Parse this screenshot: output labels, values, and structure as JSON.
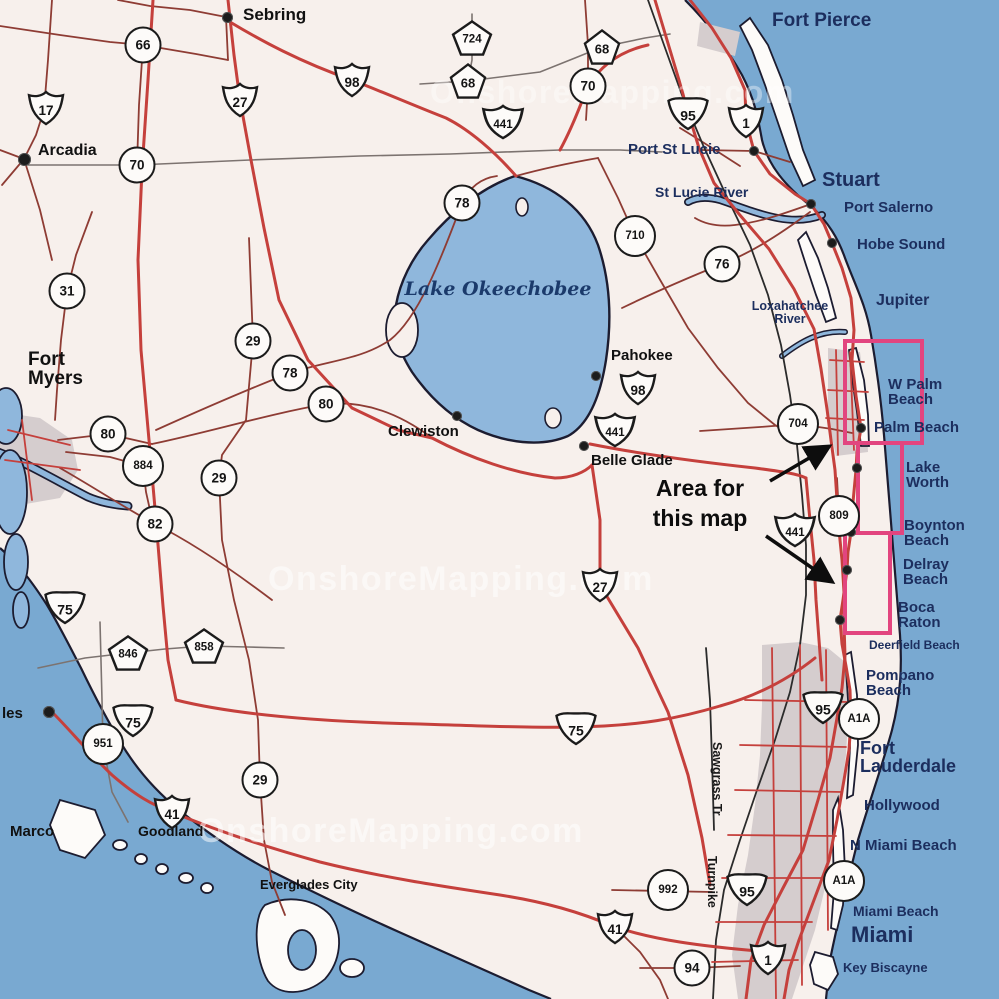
{
  "watermark": {
    "text": "OnshoreMapping.com"
  },
  "annotation": {
    "line1": "Area for",
    "line2": "this map"
  },
  "lake": {
    "label": "Lake Okeechobee"
  },
  "colors": {
    "ocean": "#79a9d1",
    "land": "#f7f0ec",
    "lake": "#8fb7dc",
    "urban": "#d5cdce",
    "road_major": "#c5403c",
    "road_minor": "#8e3c34",
    "road_gray": "#7c7370",
    "road_black": "#2b2b2b",
    "highlight_pink": "#e2457f",
    "coast_outline": "#1c1c30",
    "city_coastal": "#1c2e5e",
    "city_inland": "#111111"
  },
  "road_labels": [
    {
      "text": "Sawgrass Tr",
      "x": 724,
      "y": 742
    },
    {
      "text": "Turnpike",
      "x": 719,
      "y": 856
    }
  ],
  "shields": [
    {
      "t": "us",
      "l": "17",
      "x": 46,
      "y": 108
    },
    {
      "t": "us",
      "l": "27",
      "x": 240,
      "y": 100
    },
    {
      "t": "us",
      "l": "98",
      "x": 352,
      "y": 80
    },
    {
      "t": "us",
      "l": "441",
      "x": 503,
      "y": 122
    },
    {
      "t": "us",
      "l": "98",
      "x": 638,
      "y": 388
    },
    {
      "t": "us",
      "l": "441",
      "x": 615,
      "y": 430
    },
    {
      "t": "us",
      "l": "441",
      "x": 795,
      "y": 530
    },
    {
      "t": "us",
      "l": "27",
      "x": 600,
      "y": 585
    },
    {
      "t": "us",
      "l": "41",
      "x": 172,
      "y": 812
    },
    {
      "t": "us",
      "l": "41",
      "x": 615,
      "y": 927
    },
    {
      "t": "us",
      "l": "1",
      "x": 746,
      "y": 121
    },
    {
      "t": "us",
      "l": "1",
      "x": 768,
      "y": 958
    },
    {
      "t": "i",
      "l": "95",
      "x": 688,
      "y": 112
    },
    {
      "t": "i",
      "l": "95",
      "x": 823,
      "y": 706
    },
    {
      "t": "i",
      "l": "95",
      "x": 747,
      "y": 888
    },
    {
      "t": "i",
      "l": "75",
      "x": 65,
      "y": 606
    },
    {
      "t": "i",
      "l": "75",
      "x": 133,
      "y": 719
    },
    {
      "t": "i",
      "l": "75",
      "x": 576,
      "y": 727
    },
    {
      "t": "c",
      "l": "66",
      "x": 143,
      "y": 45
    },
    {
      "t": "c",
      "l": "70",
      "x": 137,
      "y": 165
    },
    {
      "t": "c",
      "l": "70",
      "x": 588,
      "y": 86
    },
    {
      "t": "c",
      "l": "78",
      "x": 462,
      "y": 203
    },
    {
      "t": "c",
      "l": "78",
      "x": 290,
      "y": 373
    },
    {
      "t": "c",
      "l": "710",
      "x": 635,
      "y": 236
    },
    {
      "t": "c",
      "l": "76",
      "x": 722,
      "y": 264
    },
    {
      "t": "c",
      "l": "31",
      "x": 67,
      "y": 291
    },
    {
      "t": "c",
      "l": "29",
      "x": 253,
      "y": 341
    },
    {
      "t": "c",
      "l": "80",
      "x": 326,
      "y": 404
    },
    {
      "t": "c",
      "l": "80",
      "x": 108,
      "y": 434
    },
    {
      "t": "c",
      "l": "884",
      "x": 143,
      "y": 466
    },
    {
      "t": "c",
      "l": "29",
      "x": 219,
      "y": 478
    },
    {
      "t": "c",
      "l": "82",
      "x": 155,
      "y": 524
    },
    {
      "t": "c",
      "l": "704",
      "x": 798,
      "y": 424
    },
    {
      "t": "c",
      "l": "809",
      "x": 839,
      "y": 516
    },
    {
      "t": "c",
      "l": "951",
      "x": 103,
      "y": 744
    },
    {
      "t": "c",
      "l": "29",
      "x": 260,
      "y": 780
    },
    {
      "t": "c",
      "l": "992",
      "x": 668,
      "y": 890
    },
    {
      "t": "c",
      "l": "94",
      "x": 692,
      "y": 968
    },
    {
      "t": "c",
      "l": "A1A",
      "x": 859,
      "y": 719
    },
    {
      "t": "c",
      "l": "A1A",
      "x": 844,
      "y": 881
    },
    {
      "t": "p",
      "l": "724",
      "x": 472,
      "y": 38
    },
    {
      "t": "p",
      "l": "68",
      "x": 468,
      "y": 81
    },
    {
      "t": "p",
      "l": "68",
      "x": 602,
      "y": 47
    },
    {
      "t": "p",
      "l": "846",
      "x": 128,
      "y": 653
    },
    {
      "t": "p",
      "l": "858",
      "x": 204,
      "y": 646
    }
  ],
  "cities": [
    {
      "name": "Sebring",
      "lines": [
        "Sebring"
      ],
      "x": 243,
      "y": 6,
      "cls": "i",
      "fs": 17,
      "dot": [
        227,
        17
      ],
      "ds": 11
    },
    {
      "name": "Arcadia",
      "lines": [
        "Arcadia"
      ],
      "x": 38,
      "y": 143,
      "cls": "i",
      "fs": 16,
      "dot": [
        24,
        159
      ],
      "ds": 13
    },
    {
      "name": "Fort Pierce",
      "lines": [
        "Fort Pierce"
      ],
      "x": 772,
      "y": 11,
      "cls": "c",
      "fs": 19
    },
    {
      "name": "Port St Lucie",
      "lines": [
        "Port St Lucie"
      ],
      "x": 628,
      "y": 142,
      "cls": "c",
      "fs": 15,
      "dot": [
        754,
        151
      ]
    },
    {
      "name": "St Lucie River",
      "lines": [
        "St Lucie River"
      ],
      "x": 655,
      "y": 185,
      "cls": "c",
      "fs": 14
    },
    {
      "name": "Stuart",
      "lines": [
        "Stuart"
      ],
      "x": 822,
      "y": 170,
      "cls": "c",
      "fs": 20,
      "dot": [
        811,
        204
      ]
    },
    {
      "name": "Port Salerno",
      "lines": [
        "Port Salerno"
      ],
      "x": 844,
      "y": 200,
      "cls": "c",
      "fs": 15
    },
    {
      "name": "Hobe Sound",
      "lines": [
        "Hobe Sound"
      ],
      "x": 857,
      "y": 237,
      "cls": "c",
      "fs": 15,
      "dot": [
        832,
        243
      ]
    },
    {
      "name": "Jupiter",
      "lines": [
        "Jupiter"
      ],
      "x": 876,
      "y": 293,
      "cls": "c",
      "fs": 16
    },
    {
      "name": "Loxahatchee River",
      "lines": [
        "Loxahatchee",
        "River"
      ],
      "x": 734,
      "y": 300,
      "cls": "c",
      "fs": 12.5,
      "align": "center",
      "w": 112
    },
    {
      "name": "Pahokee",
      "lines": [
        "Pahokee"
      ],
      "x": 611,
      "y": 348,
      "cls": "i",
      "fs": 15,
      "dot": [
        596,
        376
      ]
    },
    {
      "name": "Clewiston",
      "lines": [
        "Clewiston"
      ],
      "x": 388,
      "y": 424,
      "cls": "i",
      "fs": 15,
      "dot": [
        457,
        416
      ]
    },
    {
      "name": "Belle Glade",
      "lines": [
        "Belle Glade"
      ],
      "x": 591,
      "y": 453,
      "cls": "i",
      "fs": 15,
      "dot": [
        584,
        446
      ]
    },
    {
      "name": "Fort Myers",
      "lines": [
        "Fort",
        "Myers"
      ],
      "x": 28,
      "y": 350,
      "cls": "i",
      "fs": 19
    },
    {
      "name": "W Palm Beach",
      "lines": [
        "W Palm",
        "Beach"
      ],
      "x": 888,
      "y": 377,
      "cls": "c",
      "fs": 15
    },
    {
      "name": "Palm Beach",
      "lines": [
        "Palm Beach"
      ],
      "x": 874,
      "y": 420,
      "cls": "c",
      "fs": 15,
      "dot": [
        861,
        428
      ]
    },
    {
      "name": "Lake Worth",
      "lines": [
        "Lake",
        "Worth"
      ],
      "x": 906,
      "y": 460,
      "cls": "c",
      "fs": 15,
      "dot": [
        857,
        468
      ]
    },
    {
      "name": "Boynton Beach",
      "lines": [
        "Boynton",
        "Beach"
      ],
      "x": 904,
      "y": 518,
      "cls": "c",
      "fs": 15,
      "dot": [
        851,
        532
      ]
    },
    {
      "name": "Delray Beach",
      "lines": [
        "Delray",
        "Beach"
      ],
      "x": 903,
      "y": 557,
      "cls": "c",
      "fs": 15,
      "dot": [
        847,
        570
      ]
    },
    {
      "name": "Boca Raton",
      "lines": [
        "Boca",
        "Raton"
      ],
      "x": 898,
      "y": 600,
      "cls": "c",
      "fs": 15,
      "dot": [
        840,
        620
      ]
    },
    {
      "name": "Deerfield Beach",
      "lines": [
        "Deerfield Beach"
      ],
      "x": 869,
      "y": 639,
      "cls": "c",
      "fs": 12
    },
    {
      "name": "Pompano Beach",
      "lines": [
        "Pompano",
        "Beach"
      ],
      "x": 866,
      "y": 668,
      "cls": "c",
      "fs": 15
    },
    {
      "name": "Fort Lauderdale",
      "lines": [
        "Fort",
        "Lauderdale"
      ],
      "x": 860,
      "y": 739,
      "cls": "c",
      "fs": 18
    },
    {
      "name": "Hollywood",
      "lines": [
        "Hollywood"
      ],
      "x": 864,
      "y": 798,
      "cls": "c",
      "fs": 15
    },
    {
      "name": "N Miami Beach",
      "lines": [
        "N Miami Beach"
      ],
      "x": 850,
      "y": 838,
      "cls": "c",
      "fs": 15
    },
    {
      "name": "Miami Beach",
      "lines": [
        "Miami Beach"
      ],
      "x": 853,
      "y": 904,
      "cls": "c",
      "fs": 14
    },
    {
      "name": "Miami",
      "lines": [
        "Miami"
      ],
      "x": 851,
      "y": 924,
      "cls": "c",
      "fs": 22
    },
    {
      "name": "Key Biscayne",
      "lines": [
        "Key Biscayne"
      ],
      "x": 843,
      "y": 961,
      "cls": "c",
      "fs": 13
    },
    {
      "name": "Marco",
      "lines": [
        "Marco"
      ],
      "x": 10,
      "y": 824,
      "cls": "i",
      "fs": 15
    },
    {
      "name": "Goodland",
      "lines": [
        "Goodland"
      ],
      "x": 138,
      "y": 824,
      "cls": "i",
      "fs": 14
    },
    {
      "name": "Everglades City",
      "lines": [
        "Everglades City"
      ],
      "x": 260,
      "y": 878,
      "cls": "i",
      "fs": 13
    },
    {
      "name": "les",
      "lines": [
        "les"
      ],
      "x": 2,
      "y": 706,
      "cls": "i",
      "fs": 15,
      "dot": [
        49,
        712
      ],
      "ds": 12
    }
  ]
}
